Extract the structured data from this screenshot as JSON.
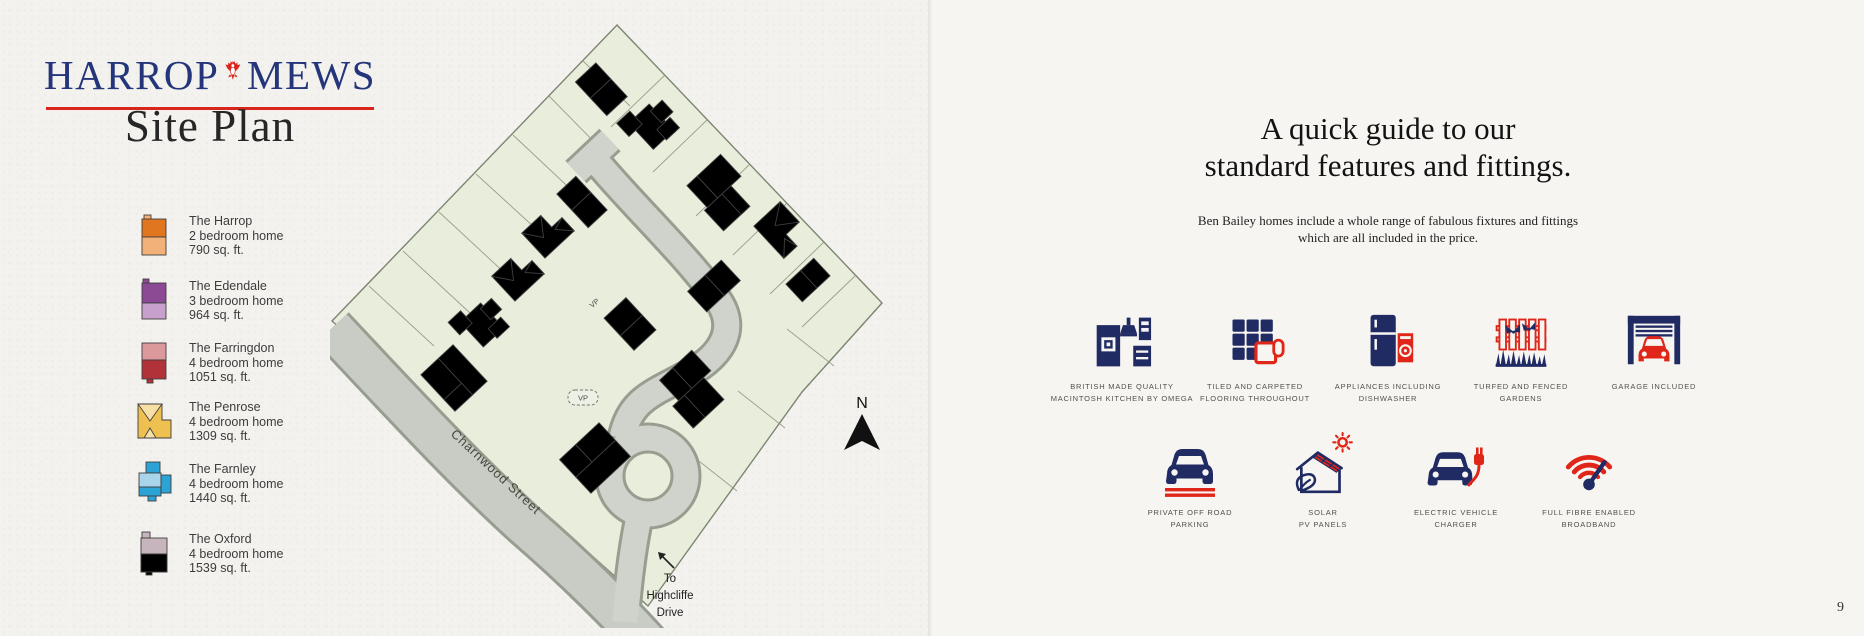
{
  "brand": {
    "name_left": "HARROP",
    "name_right": "MEWS",
    "page_title": "Site Plan"
  },
  "legend": {
    "items": [
      {
        "name": "The Harrop",
        "spec": "2 bedroom home",
        "area": "790 sq. ft.",
        "color_dark": "#e0761f",
        "color_light": "#f2b179"
      },
      {
        "name": "The Edendale",
        "spec": "3 bedroom home",
        "area": "964 sq. ft.",
        "color_dark": "#8b4a93",
        "color_light": "#c7a0cd"
      },
      {
        "name": "The Farringdon",
        "spec": "4 bedroom home",
        "area": "1051 sq. ft.",
        "color_dark": "#b23239",
        "color_light": "#dc999c"
      },
      {
        "name": "The Penrose",
        "spec": "4 bedroom home",
        "area": "1309 sq. ft.",
        "color_dark": "#eec04f",
        "color_light": "#f7e0a6"
      },
      {
        "name": "The Farnley",
        "spec": "4 bedroom home",
        "area": "1440 sq. ft.",
        "color_dark": "#2ba4d5",
        "color_light": "#a9d4ea"
      },
      {
        "name": "The Oxford",
        "spec": "4 bedroom home",
        "area": "1539 sq. ft.",
        "color_dark": "#8d7380",
        "color_light": "#c6b5bd"
      }
    ]
  },
  "site_plan": {
    "street_label": "Charnwood Street",
    "vp_label": "VP",
    "compass_label": "N",
    "exit_lines": [
      "To",
      "Highcliffe",
      "Drive"
    ],
    "plots": [
      {
        "n": "1",
        "x": 308,
        "y": 56
      },
      {
        "n": "2",
        "x": 360,
        "y": 84
      },
      {
        "n": "3",
        "x": 403,
        "y": 120
      },
      {
        "n": "4",
        "x": 438,
        "y": 148
      },
      {
        "n": "5",
        "x": 479,
        "y": 178
      },
      {
        "n": "6",
        "x": 476,
        "y": 232
      },
      {
        "n": "7",
        "x": 330,
        "y": 249
      },
      {
        "n": "8",
        "x": 309,
        "y": 277
      },
      {
        "n": "9",
        "x": 342,
        "y": 302
      },
      {
        "n": "10",
        "x": 367,
        "y": 318
      },
      {
        "n": "11",
        "x": 400,
        "y": 338
      },
      {
        "n": "12",
        "x": 417,
        "y": 352
      },
      {
        "n": "13",
        "x": 232,
        "y": 410
      },
      {
        "n": "14",
        "x": 214,
        "y": 432
      },
      {
        "n": "15",
        "x": 73,
        "y": 347
      },
      {
        "n": "16",
        "x": 91,
        "y": 325
      },
      {
        "n": "17",
        "x": 117,
        "y": 284
      },
      {
        "n": "18",
        "x": 146,
        "y": 242
      },
      {
        "n": "19",
        "x": 177,
        "y": 201
      },
      {
        "n": "20",
        "x": 207,
        "y": 164
      }
    ],
    "strips": [
      {
        "n": "1",
        "x": 239,
        "y": 140,
        "r": -43
      },
      {
        "n": "20",
        "x": 231,
        "y": 151,
        "r": -43
      },
      {
        "n": "1",
        "x": 251,
        "y": 153,
        "r": -43
      },
      {
        "n": "20",
        "x": 243,
        "y": 164,
        "r": -43
      },
      {
        "n": "2",
        "x": 328,
        "y": 162,
        "r": 47
      },
      {
        "n": "2",
        "x": 318,
        "y": 171,
        "r": 47
      },
      {
        "n": "3",
        "x": 345,
        "y": 186,
        "r": 47
      },
      {
        "n": "3",
        "x": 336,
        "y": 195,
        "r": 47
      },
      {
        "n": "4",
        "x": 398,
        "y": 224,
        "r": 47
      },
      {
        "n": "4",
        "x": 389,
        "y": 233,
        "r": 47
      },
      {
        "n": "5",
        "x": 425,
        "y": 253,
        "r": 47
      },
      {
        "n": "5",
        "x": 416,
        "y": 262,
        "r": 47
      },
      {
        "n": "6",
        "x": 452,
        "y": 282,
        "r": 47
      },
      {
        "n": "19",
        "x": 296,
        "y": 237,
        "r": -43
      },
      {
        "n": "19",
        "x": 288,
        "y": 247,
        "r": -43
      },
      {
        "n": "18",
        "x": 282,
        "y": 292,
        "r": -43
      },
      {
        "n": "18",
        "x": 274,
        "y": 302,
        "r": -43
      },
      {
        "n": "17",
        "x": 250,
        "y": 332,
        "r": -43
      },
      {
        "n": "17",
        "x": 242,
        "y": 342,
        "r": -43
      },
      {
        "n": "16",
        "x": 203,
        "y": 372,
        "r": 47
      },
      {
        "n": "15",
        "x": 212,
        "y": 383,
        "r": 47
      },
      {
        "n": "14",
        "x": 221,
        "y": 394,
        "r": 47
      },
      {
        "n": "13",
        "x": 230,
        "y": 405,
        "r": 47
      },
      {
        "n": "12",
        "x": 372,
        "y": 444,
        "r": 0
      },
      {
        "n": "12",
        "x": 372,
        "y": 457,
        "r": 0
      }
    ],
    "trees": [
      {
        "x": 297,
        "y": 32,
        "r": 10
      },
      {
        "x": 449,
        "y": 152,
        "r": 9
      },
      {
        "x": 463,
        "y": 166,
        "r": 9
      },
      {
        "x": 308,
        "y": 240,
        "r": 9
      },
      {
        "x": 291,
        "y": 261,
        "r": 9
      },
      {
        "x": 62,
        "y": 356,
        "r": 10
      },
      {
        "x": 334,
        "y": 410,
        "r": 9
      },
      {
        "x": 408,
        "y": 334,
        "r": 10
      },
      {
        "x": 452,
        "y": 343,
        "r": 9
      }
    ]
  },
  "features": {
    "heading_line1": "A quick guide to our",
    "heading_line2": "standard features and fittings.",
    "intro_line1": "Ben Bailey homes include a whole range of fabulous fixtures and fittings",
    "intro_line2": "which are all included in the price.",
    "row1": [
      {
        "icon": "kitchen-icon",
        "line1": "BRITISH MADE QUALITY",
        "line2": "MACINTOSH KITCHEN BY OMEGA"
      },
      {
        "icon": "flooring-icon",
        "line1": "TILED AND CARPETED",
        "line2": "FLOORING THROUGHOUT"
      },
      {
        "icon": "appliances-icon",
        "line1": "APPLIANCES INCLUDING",
        "line2": "DISHWASHER"
      },
      {
        "icon": "garden-icon",
        "line1": "TURFED AND FENCED",
        "line2": "GARDENS"
      },
      {
        "icon": "garage-icon",
        "line1": "GARAGE INCLUDED",
        "line2": ""
      }
    ],
    "row2": [
      {
        "icon": "parking-icon",
        "line1": "PRIVATE OFF ROAD",
        "line2": "PARKING"
      },
      {
        "icon": "solar-icon",
        "line1": "SOLAR",
        "line2": "PV PANELS"
      },
      {
        "icon": "ev-charger-icon",
        "line1": "ELECTRIC VEHICLE",
        "line2": "CHARGER"
      },
      {
        "icon": "broadband-icon",
        "line1": "FULL FIBRE ENABLED",
        "line2": "BROADBAND"
      }
    ]
  },
  "page_number": "9",
  "colors": {
    "brand_navy": "#24357b",
    "brand_red": "#d9261d",
    "icon_navy": "#202a63",
    "icon_red": "#e02619",
    "site_green": "#e8eedb",
    "road_gray": "#c8ccc4"
  }
}
